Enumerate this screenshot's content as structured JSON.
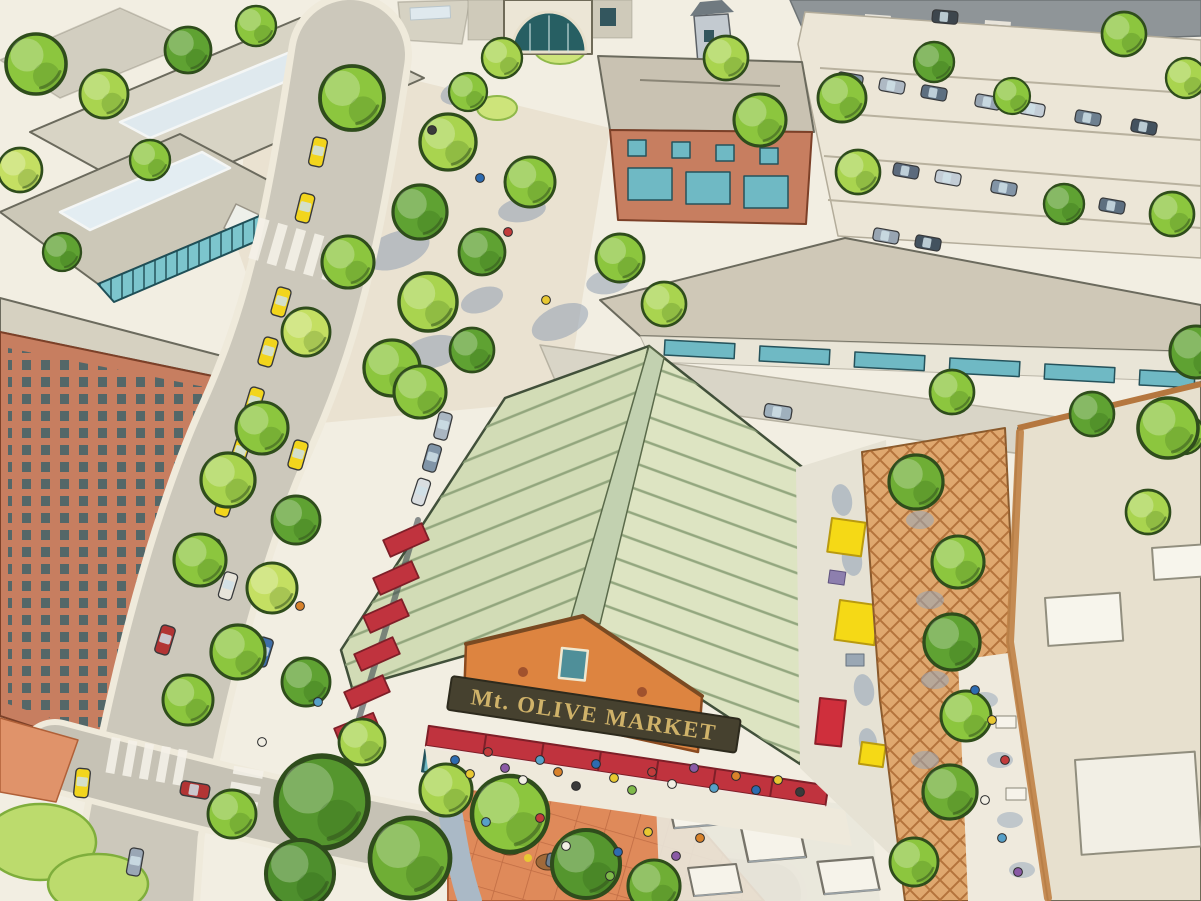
{
  "image": {
    "kind": "watercolor aerial rendering",
    "subject": "Mixed-use town center: public market hall with green standing-seam roof, tree-lined main street with taxis, terracotta market plaza, trellis patio and surface parking",
    "width_px": 1201,
    "height_px": 901
  },
  "market": {
    "sign_text": "Mt. OLIVE MARKET",
    "roof_style": "standing-seam gable roof",
    "colors": {
      "roof_left": "#d2dcb6",
      "roof_right": "#dde4c2",
      "roof_ridge": "#c2d1b0",
      "roof_seam": "#8ba077",
      "gable_wall": "#dd8440",
      "sign_band": "#46412f",
      "sign_letters": "#cfb269",
      "awning_red": "#c0333e",
      "storefront_glass": "#6fb9c4"
    }
  },
  "environment": {
    "paper": "#f2eee2",
    "street": "#ccc8bb",
    "curb": "#efeadb",
    "plaza_paving": "#eae2d1",
    "terracotta_plaza": "#df8a5a",
    "trellis_patio": "#dfa86f",
    "parking_lot": "#ece6d7",
    "asphalt_road": "#8f9598",
    "tan_roof": "#e7e0ce",
    "gray_roof": "#d8d4c5",
    "brick_building": "#c77e60",
    "taxi_yellow": "#f2d51d",
    "umbrella_yellow": "#f5d916",
    "umbrella_red": "#cf2f3c",
    "lawn": "#bcdb6d",
    "tree_green": "#86c33e"
  },
  "features": [
    {
      "name": "market-hall",
      "label": "Public market hall with green standing-seam roof, red awnings and gold sign"
    },
    {
      "name": "main-street",
      "label": "Tree-lined main street with queued yellow taxis and storefront buildings"
    },
    {
      "name": "market-plaza",
      "label": "Terracotta paved plaza with market crowds, stalls and cafe canopies"
    },
    {
      "name": "trellis-patio",
      "label": "Vine-covered trellis patio with yellow and red cafe umbrellas"
    },
    {
      "name": "parking-lot",
      "label": "Surface parking lot with rows of cars and tree islands"
    },
    {
      "name": "mixed-use-blocks",
      "label": "Flat-roofed mixed-use brick blocks with skylights and teal storefronts"
    },
    {
      "name": "arched-entry",
      "label": "Arched glass entry pavilion on the background block"
    },
    {
      "name": "retail-strip",
      "label": "One-story retail strip behind the market hall"
    }
  ]
}
